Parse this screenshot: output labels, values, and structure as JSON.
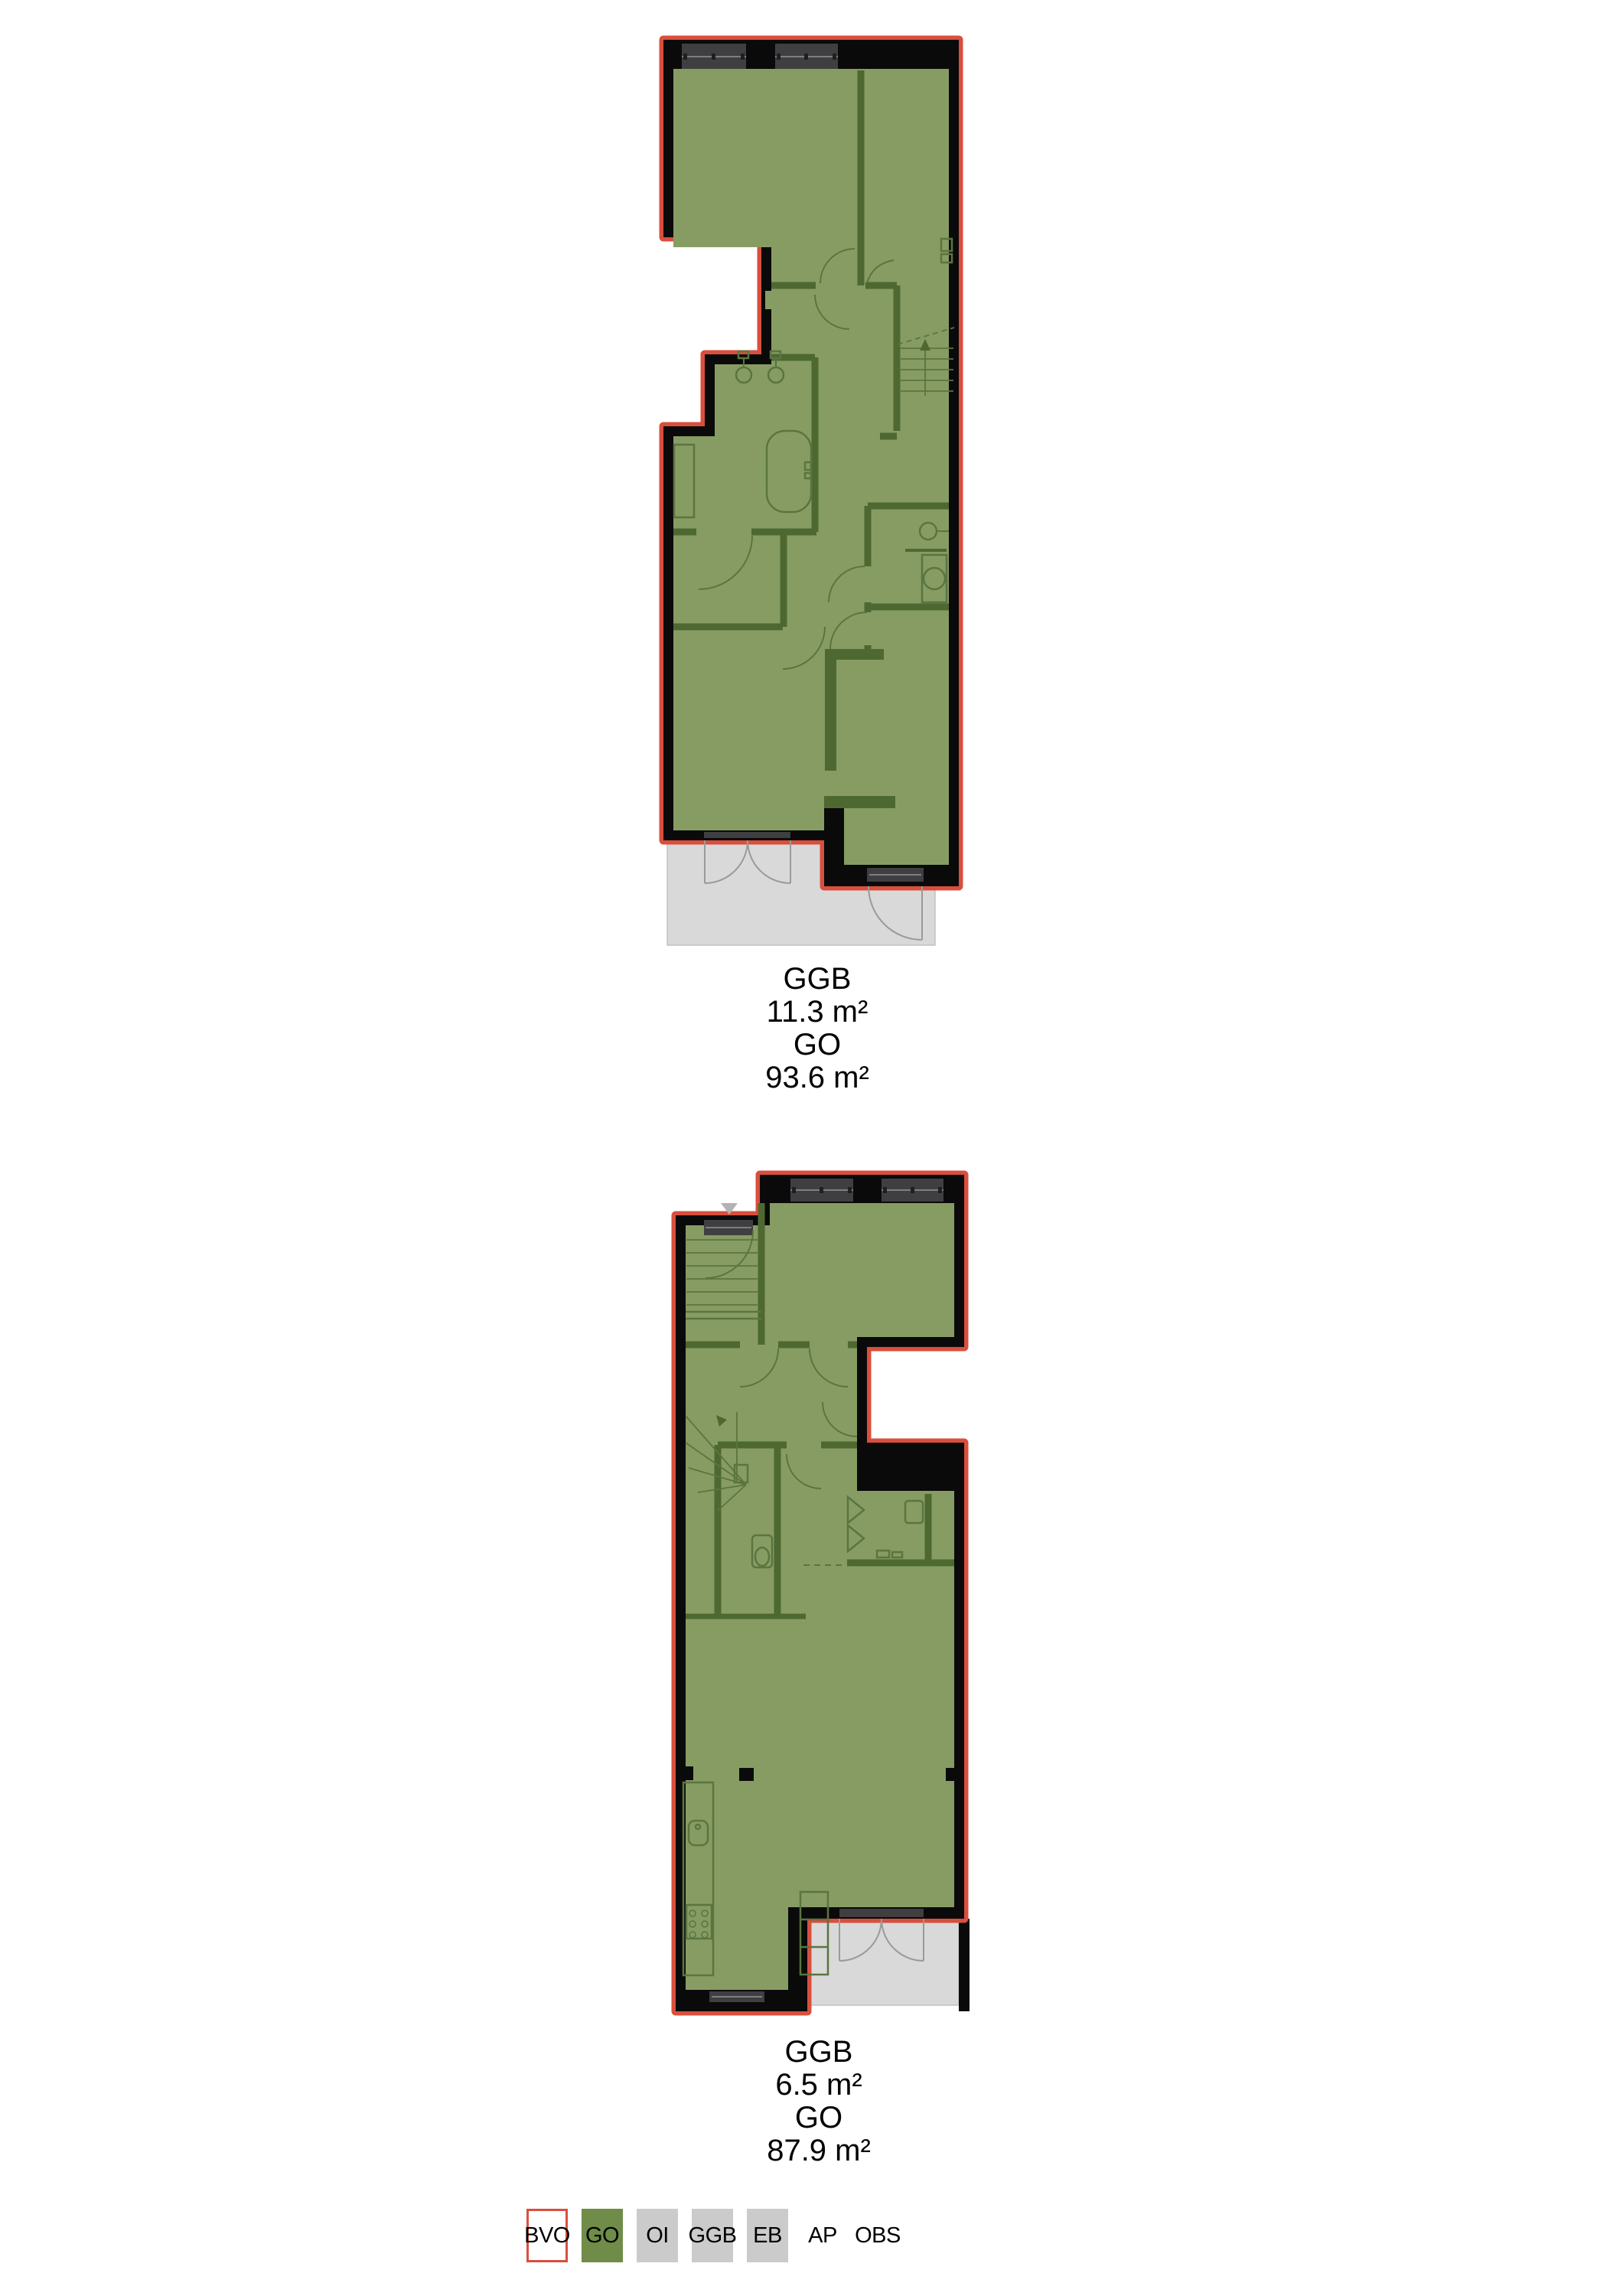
{
  "plans": [
    {
      "id": "upper-floor",
      "stats": [
        {
          "label": "GGB",
          "value": "11.3 m²"
        },
        {
          "label": "GO",
          "value": "93.6 m²"
        }
      ]
    },
    {
      "id": "ground-floor",
      "stats": [
        {
          "label": "GGB",
          "value": "6.5 m²"
        },
        {
          "label": "GO",
          "value": "87.9 m²"
        }
      ]
    }
  ],
  "legend": {
    "items": [
      {
        "label": "BVO",
        "fill": "#FFFFFF",
        "border": "#D94F3D"
      },
      {
        "label": "GO",
        "fill": "#6F8C49"
      },
      {
        "label": "OI",
        "fill": "#CBCBCB"
      },
      {
        "label": "GGB",
        "fill": "#CBCBCB"
      },
      {
        "label": "EB",
        "fill": "#CBCBCB"
      },
      {
        "label": "AP",
        "fill": "none"
      },
      {
        "label": "OBS",
        "fill": "none"
      }
    ]
  },
  "colors": {
    "floor_fill": "#879C63",
    "partition_wall": "#4E6832",
    "exterior_wall": "#0A0A0A",
    "bvo_outline": "#D94F3D",
    "window_glass": "#3F3F41",
    "terrace": "#D9D9D9",
    "marker": "#B3B3B3"
  }
}
